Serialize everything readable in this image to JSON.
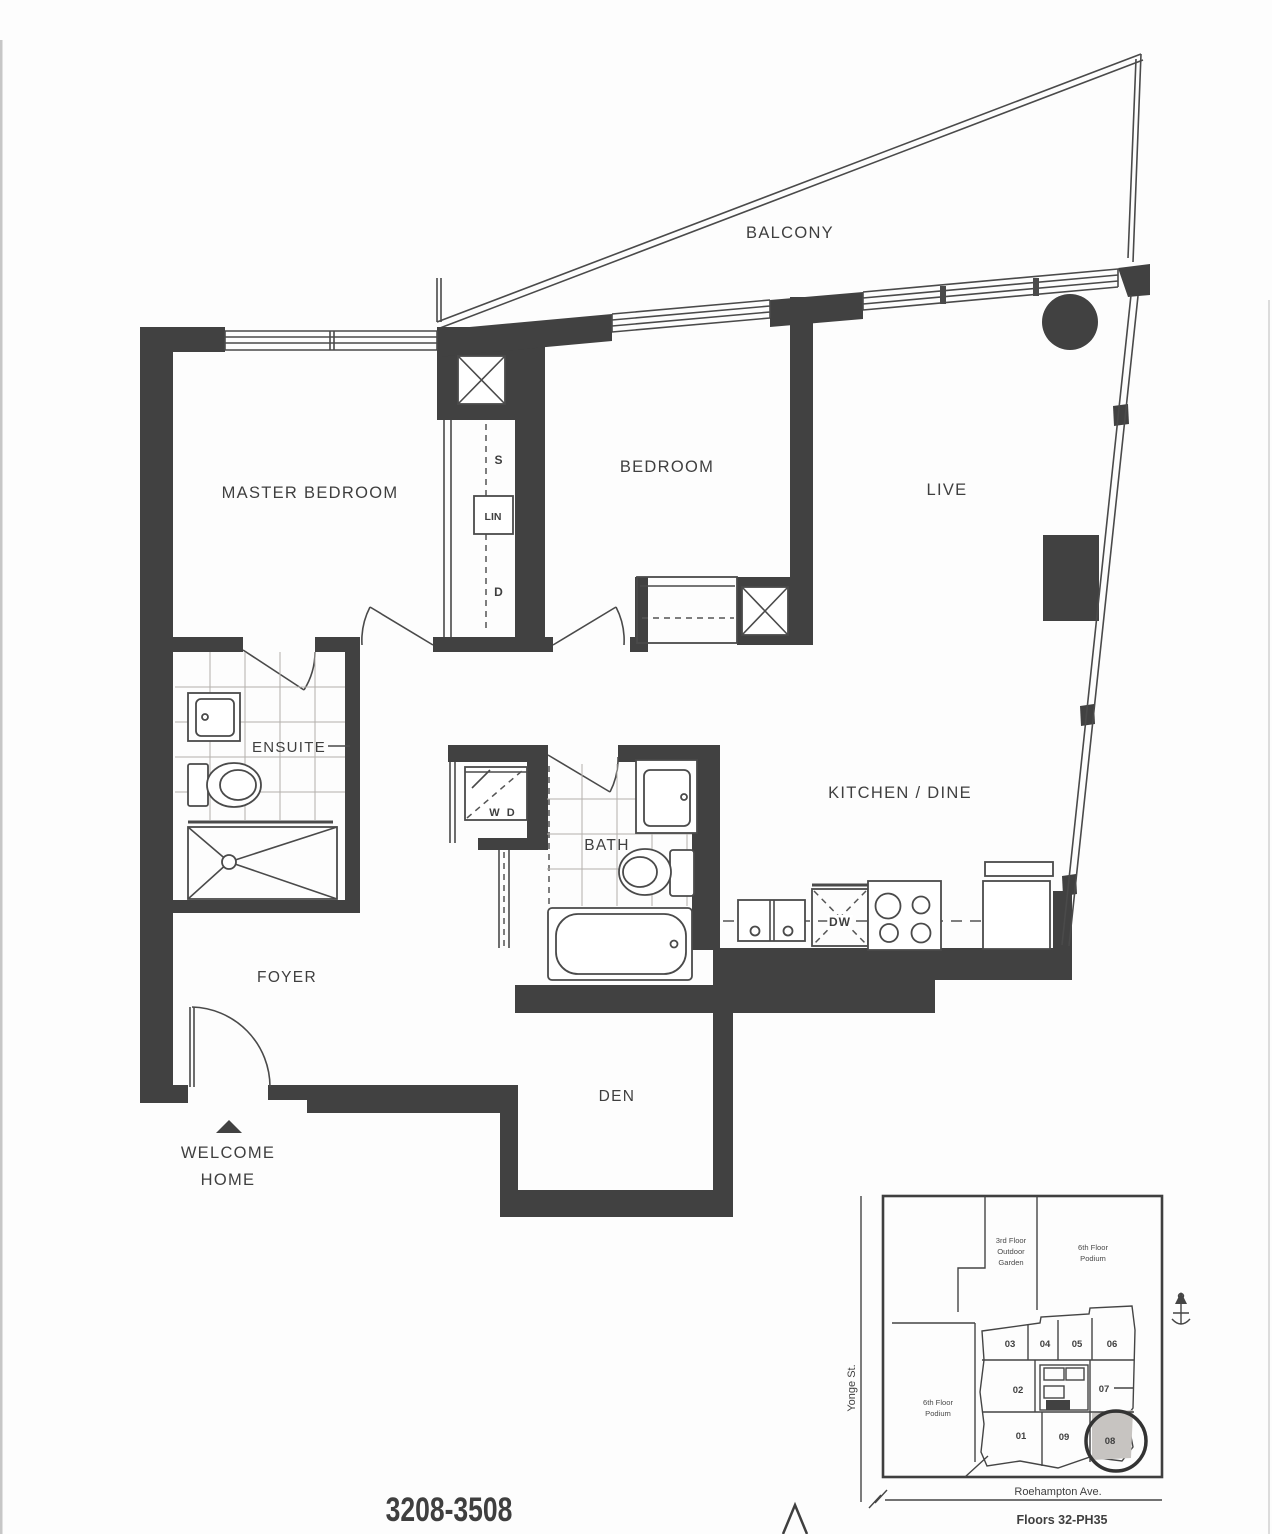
{
  "title": {
    "unit_range": "3208-3508"
  },
  "colors": {
    "wall": "#414141",
    "line": "#4a4a4a",
    "text": "#3f3f3f",
    "tile_grid": "#b3b0ac",
    "highlight_unit_fill": "#c7c4c1",
    "background": "#fdfdfd"
  },
  "plan": {
    "rooms": {
      "balcony": "BALCONY",
      "master_bedroom": "MASTER BEDROOM",
      "bedroom": "BEDROOM",
      "live": "LIVE",
      "ensuite": "ENSUITE",
      "bath": "BATH",
      "kitchen_dine": "KITCHEN / DINE",
      "foyer": "FOYER",
      "den": "DEN"
    },
    "closet": {
      "shelf": "S",
      "linen": "LIN",
      "drawers": "D"
    },
    "fixtures": {
      "washer_dryer": "W D",
      "dishwasher": "DW"
    },
    "entry": {
      "line1": "WELCOME",
      "line2": "HOME"
    }
  },
  "keyplan": {
    "garden": [
      "3rd Floor",
      "Outdoor",
      "Garden"
    ],
    "podium_right": [
      "6th Floor",
      "Podium"
    ],
    "podium_left": [
      "6th Floor",
      "Podium"
    ],
    "units": [
      "03",
      "04",
      "05",
      "06",
      "02",
      "07",
      "01",
      "09",
      "08"
    ],
    "highlighted_unit": "08",
    "street_left": "Yonge St.",
    "street_bottom": "Roehampton Ave.",
    "floors_note": "Floors 32-PH35"
  }
}
